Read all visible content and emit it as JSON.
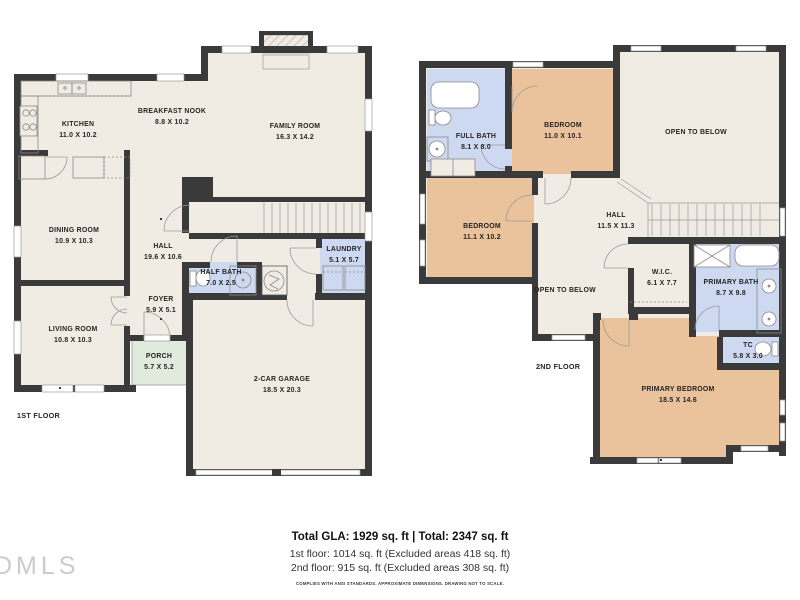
{
  "first_floor": {
    "label": "1ST FLOOR",
    "rooms": [
      {
        "name": "KITCHEN",
        "dims": "11.0 X 10.2"
      },
      {
        "name": "BREAKFAST NOOK",
        "dims": "8.8 X 10.2"
      },
      {
        "name": "FAMILY ROOM",
        "dims": "16.3 X 14.2"
      },
      {
        "name": "DINING ROOM",
        "dims": "10.9 X 10.3"
      },
      {
        "name": "HALL",
        "dims": "19.6 X 10.6"
      },
      {
        "name": "FOYER",
        "dims": "5.9 X 5.1"
      },
      {
        "name": "LIVING ROOM",
        "dims": "10.8 X 10.3"
      },
      {
        "name": "PORCH",
        "dims": "5.7 X 5.2"
      },
      {
        "name": "HALF BATH",
        "dims": "7.0 X 2.5"
      },
      {
        "name": "LAUNDRY",
        "dims": "5.1 X 5.7"
      },
      {
        "name": "2-CAR GARAGE",
        "dims": "18.5 X 20.3"
      }
    ]
  },
  "second_floor": {
    "label": "2ND FLOOR",
    "rooms": [
      {
        "name": "FULL BATH",
        "dims": "8.1 X 8.0"
      },
      {
        "name": "BEDROOM",
        "dims": "11.0 X 10.1"
      },
      {
        "name": "OPEN TO BELOW",
        "dims": ""
      },
      {
        "name": "BEDROOM",
        "dims": "11.1 X 10.2"
      },
      {
        "name": "HALL",
        "dims": "11.5 X 11.3"
      },
      {
        "name": "OPEN TO BELOW",
        "dims": ""
      },
      {
        "name": "W.I.C.",
        "dims": "6.1 X 7.7"
      },
      {
        "name": "PRIMARY BATH",
        "dims": "8.7 X 9.8"
      },
      {
        "name": "TC",
        "dims": "5.8 X 3.0"
      },
      {
        "name": "PRIMARY BEDROOM",
        "dims": "18.5 X 14.6"
      }
    ]
  },
  "summary": {
    "total_line": "Total GLA: 1929 sq. ft | Total: 2347 sq. ft",
    "first_floor_line": "1st floor: 1014 sq. ft (Excluded areas 418 sq. ft)",
    "second_floor_line": "2nd floor: 915 sq. ft (Excluded areas 308 sq. ft)",
    "disclaimer": "COMPLIES WITH ANSI STANDARDS. APPROXIMATE DIMENSIONS. DRAWING NOT TO SCALE."
  },
  "watermark": "DMLS",
  "colors": {
    "wall": "#3a3a3a",
    "floor": "#f1ece3",
    "bedroom": "#eac29b",
    "bath": "#cdd8f1",
    "porch": "#e0eadd",
    "background": "#ffffff"
  }
}
